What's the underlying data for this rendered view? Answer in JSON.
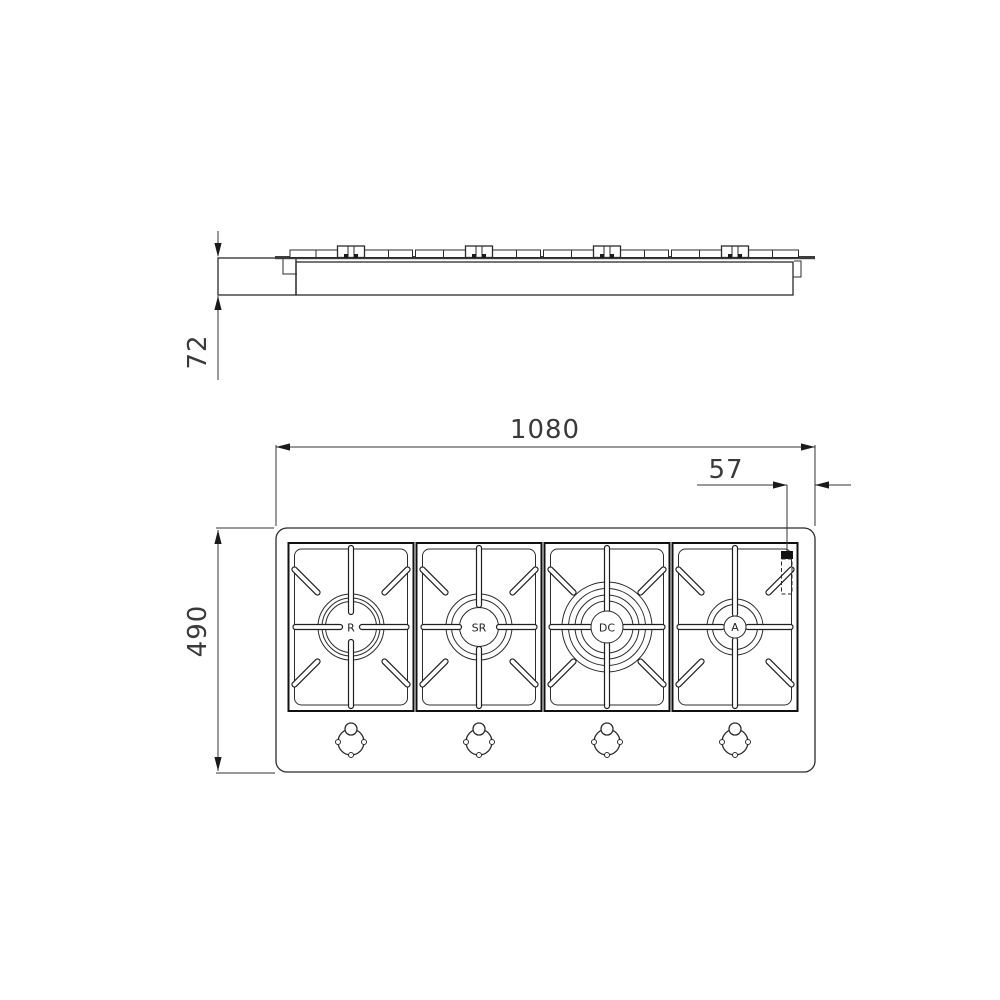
{
  "colors": {
    "background": "#ffffff",
    "line": "#222222",
    "marker": "#111111"
  },
  "dimensions": {
    "overall_width": "1080",
    "inlet_offset": "57",
    "overall_depth": "490",
    "installation_height": "72"
  },
  "burners": [
    {
      "label": "R"
    },
    {
      "label": "SR"
    },
    {
      "label": "DC"
    },
    {
      "label": "A"
    }
  ]
}
